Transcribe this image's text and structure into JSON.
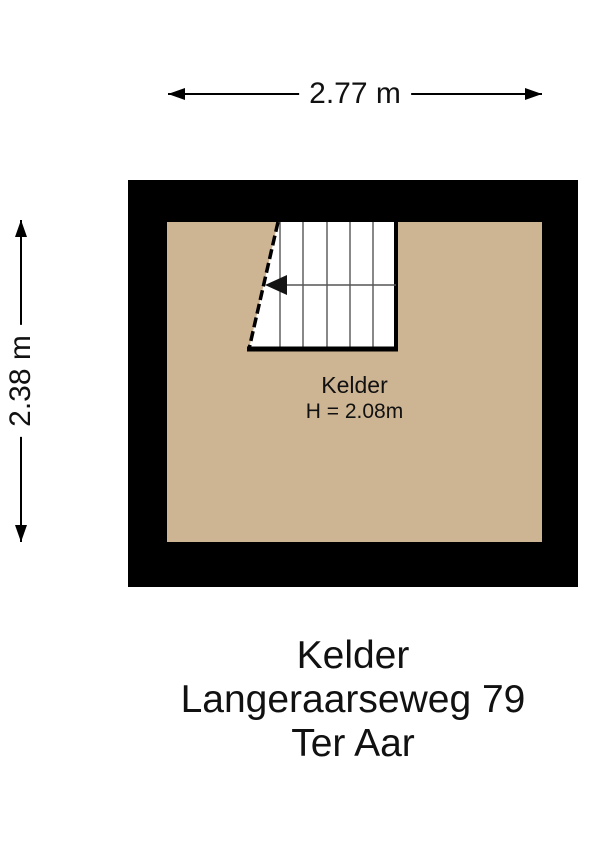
{
  "dimensions": {
    "width": {
      "label": "2.77 m"
    },
    "height": {
      "label": "2.38 m"
    }
  },
  "plan": {
    "room": {
      "name": "Kelder",
      "ceiling_height": "H = 2.08m"
    }
  },
  "footer": {
    "room": "Kelder",
    "address": "Langeraarseweg 79",
    "city": "Ter Aar"
  },
  "colors": {
    "background": "#ffffff",
    "wall": "#000000",
    "floor": "#cdb493",
    "stair": "#ffffff"
  }
}
